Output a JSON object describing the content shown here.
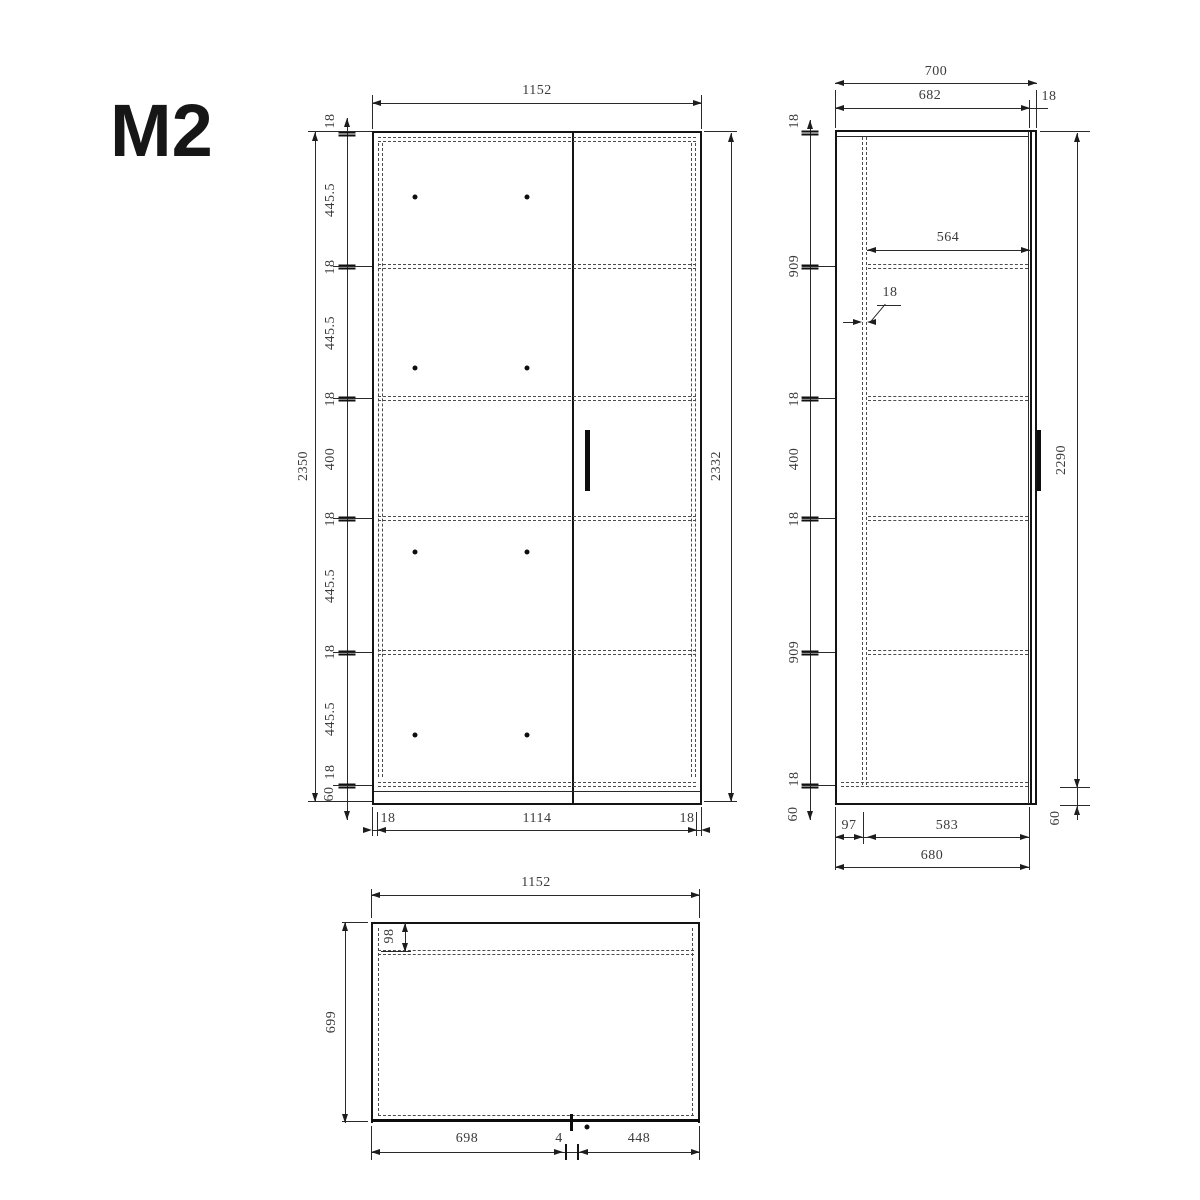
{
  "title": "M2",
  "colors": {
    "line": "#2a2a2a",
    "text": "#3b3b3b",
    "background": "#ffffff"
  },
  "front_view": {
    "width_top": "1152",
    "left_chain": [
      "18",
      "445.5",
      "18",
      "445.5",
      "18",
      "400",
      "18",
      "445.5",
      "18",
      "445.5",
      "18",
      "60"
    ],
    "height_overall": "2350",
    "height_right": "2332",
    "bottom_chain": [
      "18",
      "1114",
      "18"
    ]
  },
  "side_view": {
    "depth_top": "700",
    "depth_inner": "682",
    "door_thickness": "18",
    "shelf_depth": "564",
    "back_panel_thickness": "18",
    "left_chain": [
      "18",
      "909",
      "18",
      "400",
      "18",
      "909",
      "18",
      "60"
    ],
    "height_body": "2290",
    "base_height": "60",
    "bottom_front_offset": "97",
    "bottom_inner": "583",
    "bottom_overall": "680"
  },
  "plan_view": {
    "width_top": "1152",
    "back_rail_depth": "98",
    "depth_overall": "699",
    "bottom_chain": [
      "698",
      "4",
      "448"
    ]
  }
}
